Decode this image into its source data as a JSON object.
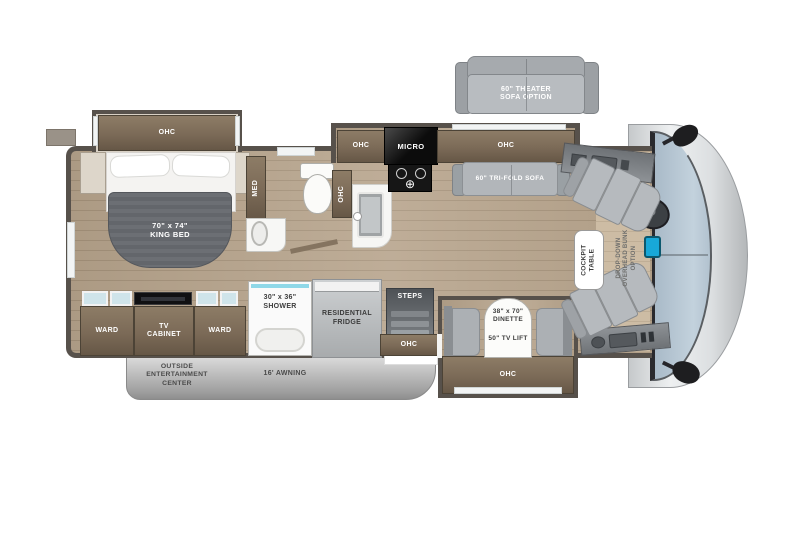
{
  "colors": {
    "wall": "#57514b",
    "cabinet_brown": "#7b6a57",
    "floor_wood": "#b7a48c",
    "shower_glass_accent": "#8fd8e8",
    "windshield_blue": "#b9c9d6",
    "seat_gray": "#b6babe",
    "banner_gray": "#bdbdbd"
  },
  "floorplan": {
    "options": {
      "theater_sofa": {
        "line1": "60\" THEATER",
        "line2": "SOFA OPTION"
      },
      "overhead_bunk": {
        "line1": "DROP-DOWN",
        "line2": "OVERHEAD BUNK",
        "line3": "OPTION"
      }
    },
    "bedroom": {
      "ohc": "OHC",
      "bed": {
        "line1": "70\" x 74\"",
        "line2": "KING BED"
      },
      "ward_left": "WARD",
      "tv_cabinet": {
        "line1": "TV",
        "line2": "CABINET"
      },
      "ward_right": "WARD"
    },
    "bath": {
      "med": "MED",
      "ohc": "OHC",
      "shower": {
        "line1": "30\" x 36\"",
        "line2": "SHOWER"
      }
    },
    "galley": {
      "ohc_left": "OHC",
      "micro": "MICRO",
      "ohc_right": "OHC",
      "fridge": {
        "line1": "RESIDENTIAL",
        "line2": "FRIDGE"
      },
      "steps": "STEPS",
      "steps_ohc": "OHC"
    },
    "living": {
      "trifold_sofa": "60\" TRI-FOLD SOFA",
      "dinette": {
        "line1": "38\" x 70\"",
        "line2": "DINETTE"
      },
      "tv_lift": "50\" TV LIFT",
      "dinette_ohc": "OHC"
    },
    "cockpit": {
      "table": {
        "line1": "COCKPIT",
        "line2": "TABLE"
      }
    },
    "exterior": {
      "entertainment": {
        "line1": "OUTSIDE",
        "line2": "ENTERTAINMENT",
        "line3": "CENTER"
      },
      "awning": "16' AWNING"
    }
  }
}
